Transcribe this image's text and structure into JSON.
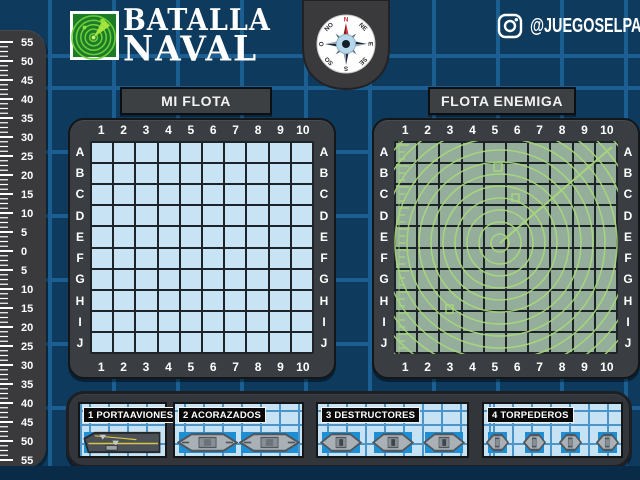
{
  "logo": {
    "line1": "BATALLA",
    "line2": "NAVAL",
    "icon": "radar-logo"
  },
  "social": {
    "icon": "instagram",
    "handle": "@JUEGOSELPATO"
  },
  "compass": {
    "directions": [
      "N",
      "NE",
      "E",
      "SE",
      "S",
      "SO",
      "O",
      "NO"
    ],
    "north_color": "#c1272d"
  },
  "ruler": {
    "labels": [
      "55",
      "50",
      "45",
      "40",
      "35",
      "30",
      "25",
      "20",
      "15",
      "10",
      "5",
      "0",
      "5",
      "10",
      "15",
      "20",
      "25",
      "30",
      "35",
      "40",
      "45",
      "50",
      "55"
    ]
  },
  "boards": {
    "my": {
      "title": "MI FLOTA",
      "cols": [
        "1",
        "2",
        "3",
        "4",
        "5",
        "6",
        "7",
        "8",
        "9",
        "10"
      ],
      "rows": [
        "A",
        "B",
        "C",
        "D",
        "E",
        "F",
        "G",
        "H",
        "I",
        "J"
      ],
      "cell_color": "#c8e3f3"
    },
    "enemy": {
      "title": "FLOTA ENEMIGA",
      "cols": [
        "1",
        "2",
        "3",
        "4",
        "5",
        "6",
        "7",
        "8",
        "9",
        "10"
      ],
      "rows": [
        "A",
        "B",
        "C",
        "D",
        "E",
        "F",
        "G",
        "H",
        "I",
        "J"
      ],
      "cell_color": "#95ae9c",
      "overlay": "radar-sweep"
    }
  },
  "legend": {
    "panels": [
      {
        "label": "1 PORTAAVIONES",
        "ship_type": "carrier",
        "count": 1,
        "size_cells": 4
      },
      {
        "label": "2 ACORAZADOS",
        "ship_type": "battleship",
        "count": 2,
        "size_cells": 3
      },
      {
        "label": "3 DESTRUCTORES",
        "ship_type": "destroyer",
        "count": 3,
        "size_cells": 2
      },
      {
        "label": "4 TORPEDEROS",
        "ship_type": "torpedo",
        "count": 4,
        "size_cells": 1
      }
    ]
  },
  "colors": {
    "background": "#0d3a5d",
    "grid_line": "#1b5e91",
    "frame_dark": "#3a3e42",
    "my_cell": "#c8e3f3",
    "enemy_cell": "#95ae9c",
    "radar_green": "#a8da78",
    "ship_highlight": "#1e8fd4",
    "ruler_gray": "#3a3a3c",
    "text_white": "#ffffff"
  }
}
